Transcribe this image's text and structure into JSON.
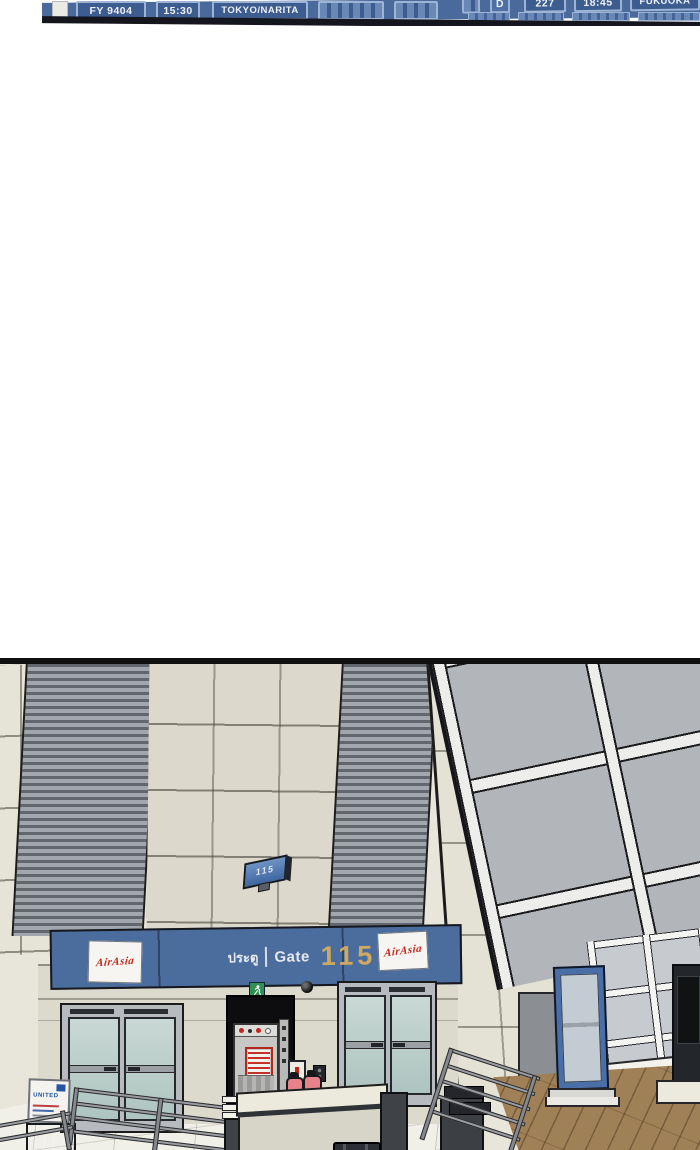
{
  "scene": {
    "kind": "webtoon comic panel",
    "setting": "airport terminal boarding gate"
  },
  "flight_board": {
    "row_upper": {
      "gate": "D",
      "flight": "227",
      "time": "18:45",
      "destination": "FUKUOKA"
    },
    "row_lower": {
      "flight": "FY 9404",
      "time": "15:30",
      "destination": "TOKYO/NARITA"
    }
  },
  "gate": {
    "hanging_sign_number": "115",
    "banner": {
      "thai_word": "ประตู",
      "gate_word": "Gate",
      "number": "115",
      "airline": "AirAsia"
    },
    "united_sign": {
      "brand": "UNITED"
    }
  },
  "icons": {
    "exit_sign": "green running-man exit sign",
    "security_camera": "black dome camera",
    "fire_extinguishers": 2,
    "fire_alarm": "wall fire-alarm box"
  },
  "colors": {
    "board_blue": "#4a6a9c",
    "board_cell": "#3d5c90",
    "banner_blue": "#4a6d9e",
    "gate_number_gold": "#cfa95f",
    "airasia_red": "#c6271b",
    "exit_green": "#2f8f56",
    "extinguisher_pink": "#e8828a",
    "door_glass_teal": "#b5c9c5",
    "wood_floor": "#a08057",
    "rib_panel_gray": "#62676f"
  }
}
